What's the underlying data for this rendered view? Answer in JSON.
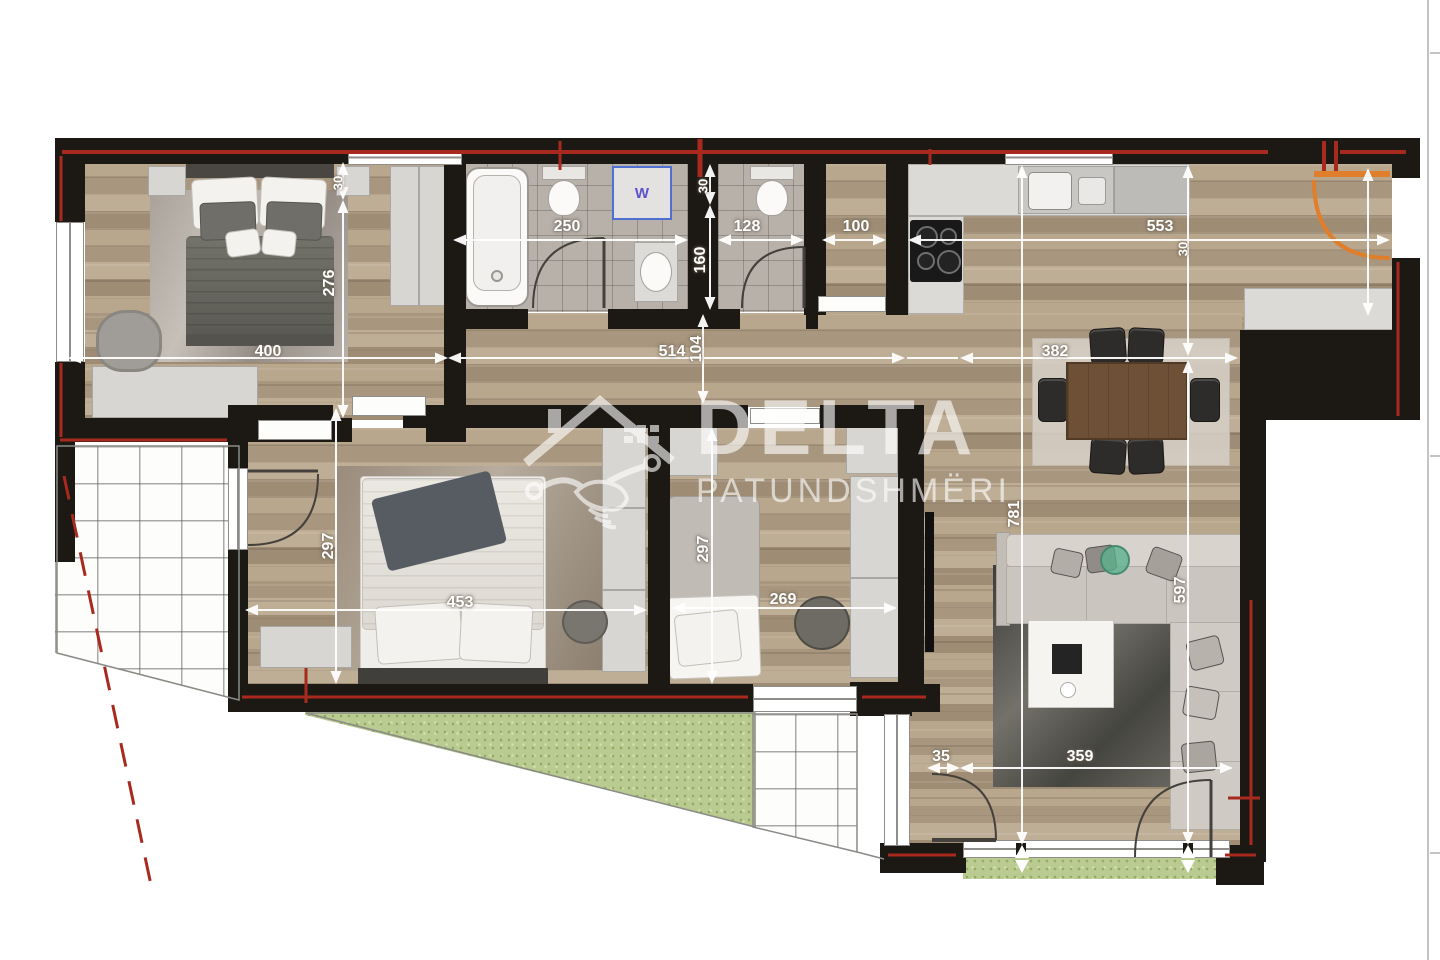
{
  "watermark": {
    "title": "DELTA",
    "subtitle": "PATUNDSHMËRI"
  },
  "appliances": {
    "washer_label": "W"
  },
  "colors": {
    "wall": "#1c1814",
    "accent_red": "#a82a1e",
    "entrance_door_orange": "#e07e2c",
    "washer_blue": "#4f6fd2",
    "dimension_text": "#ffffff"
  },
  "dims": {
    "bedroom1_width": "400",
    "bedroom1_height": "276",
    "bedroom1_offset": "30",
    "bath1_width": "250",
    "bath_wall_offset": "30",
    "bath2_depth": "160",
    "bath2_width": "128",
    "hall_width": "100",
    "kitchen_width": "553",
    "kitchen_offset": "30",
    "corridor_length": "514",
    "corridor_width": "104",
    "dining_width": "382",
    "living_height": "781",
    "living_inner_height": "597",
    "bedroom2_width": "453",
    "bedroom2_height": "297",
    "bedroom3_width": "269",
    "bedroom3_height": "297",
    "terrace_door_offset": "35",
    "living_bottom_width": "359"
  }
}
